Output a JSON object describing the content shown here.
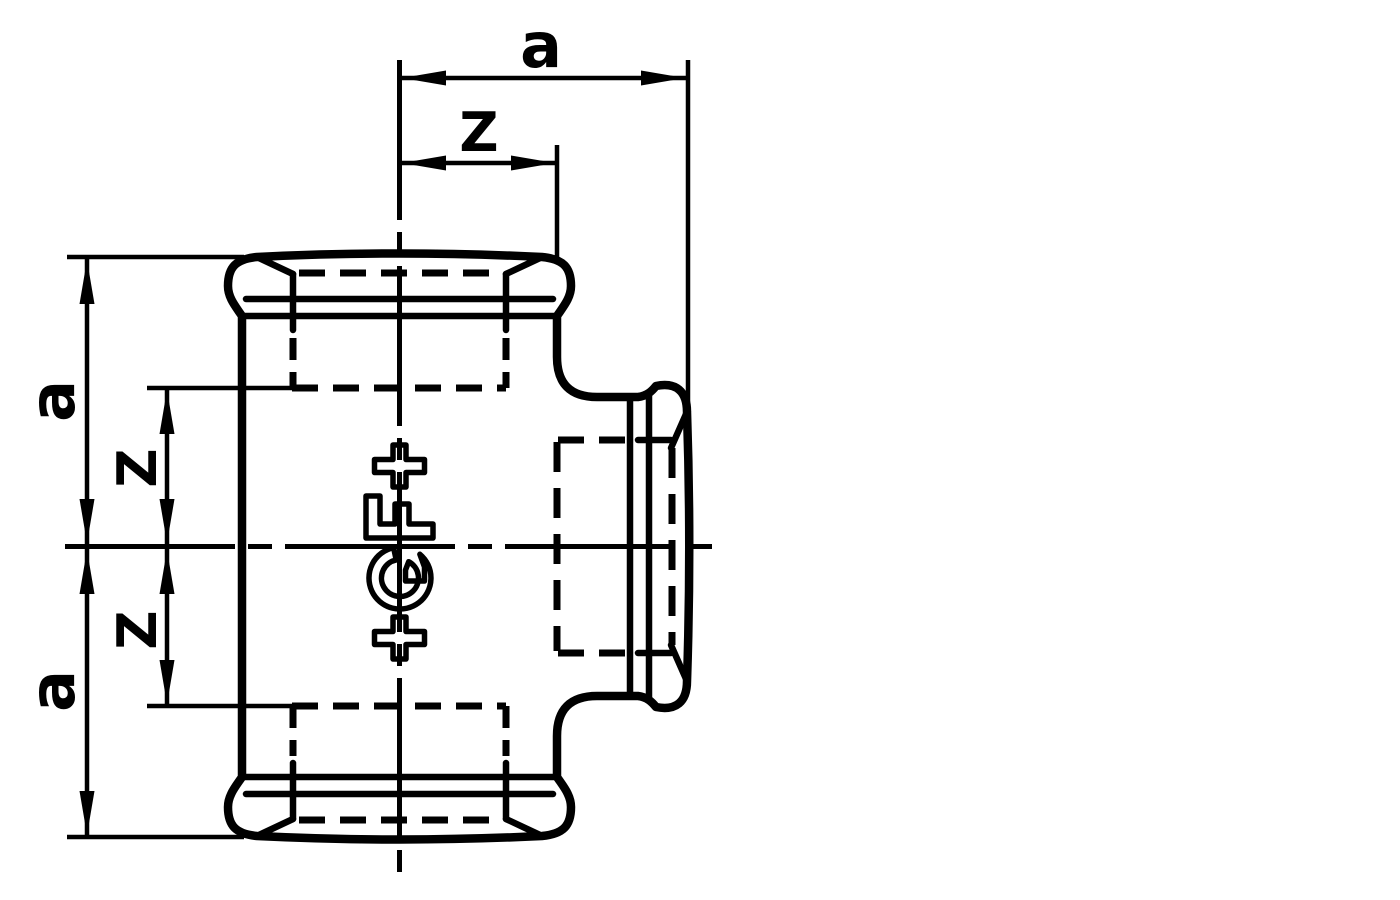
{
  "page": {
    "background": "#ffffff",
    "ink": "#000000",
    "kind": "technical line drawing",
    "subject": "Threaded tee pipe fitting, front elevation with dimension lines"
  },
  "drawing": {
    "logo": {
      "text": "+GF+"
    },
    "dim_labels": {
      "top_a": "a",
      "top_z": "Z",
      "left_top_a": "a",
      "left_top_z": "Z",
      "left_bottom_z": "Z",
      "left_bottom_a": "a"
    }
  }
}
